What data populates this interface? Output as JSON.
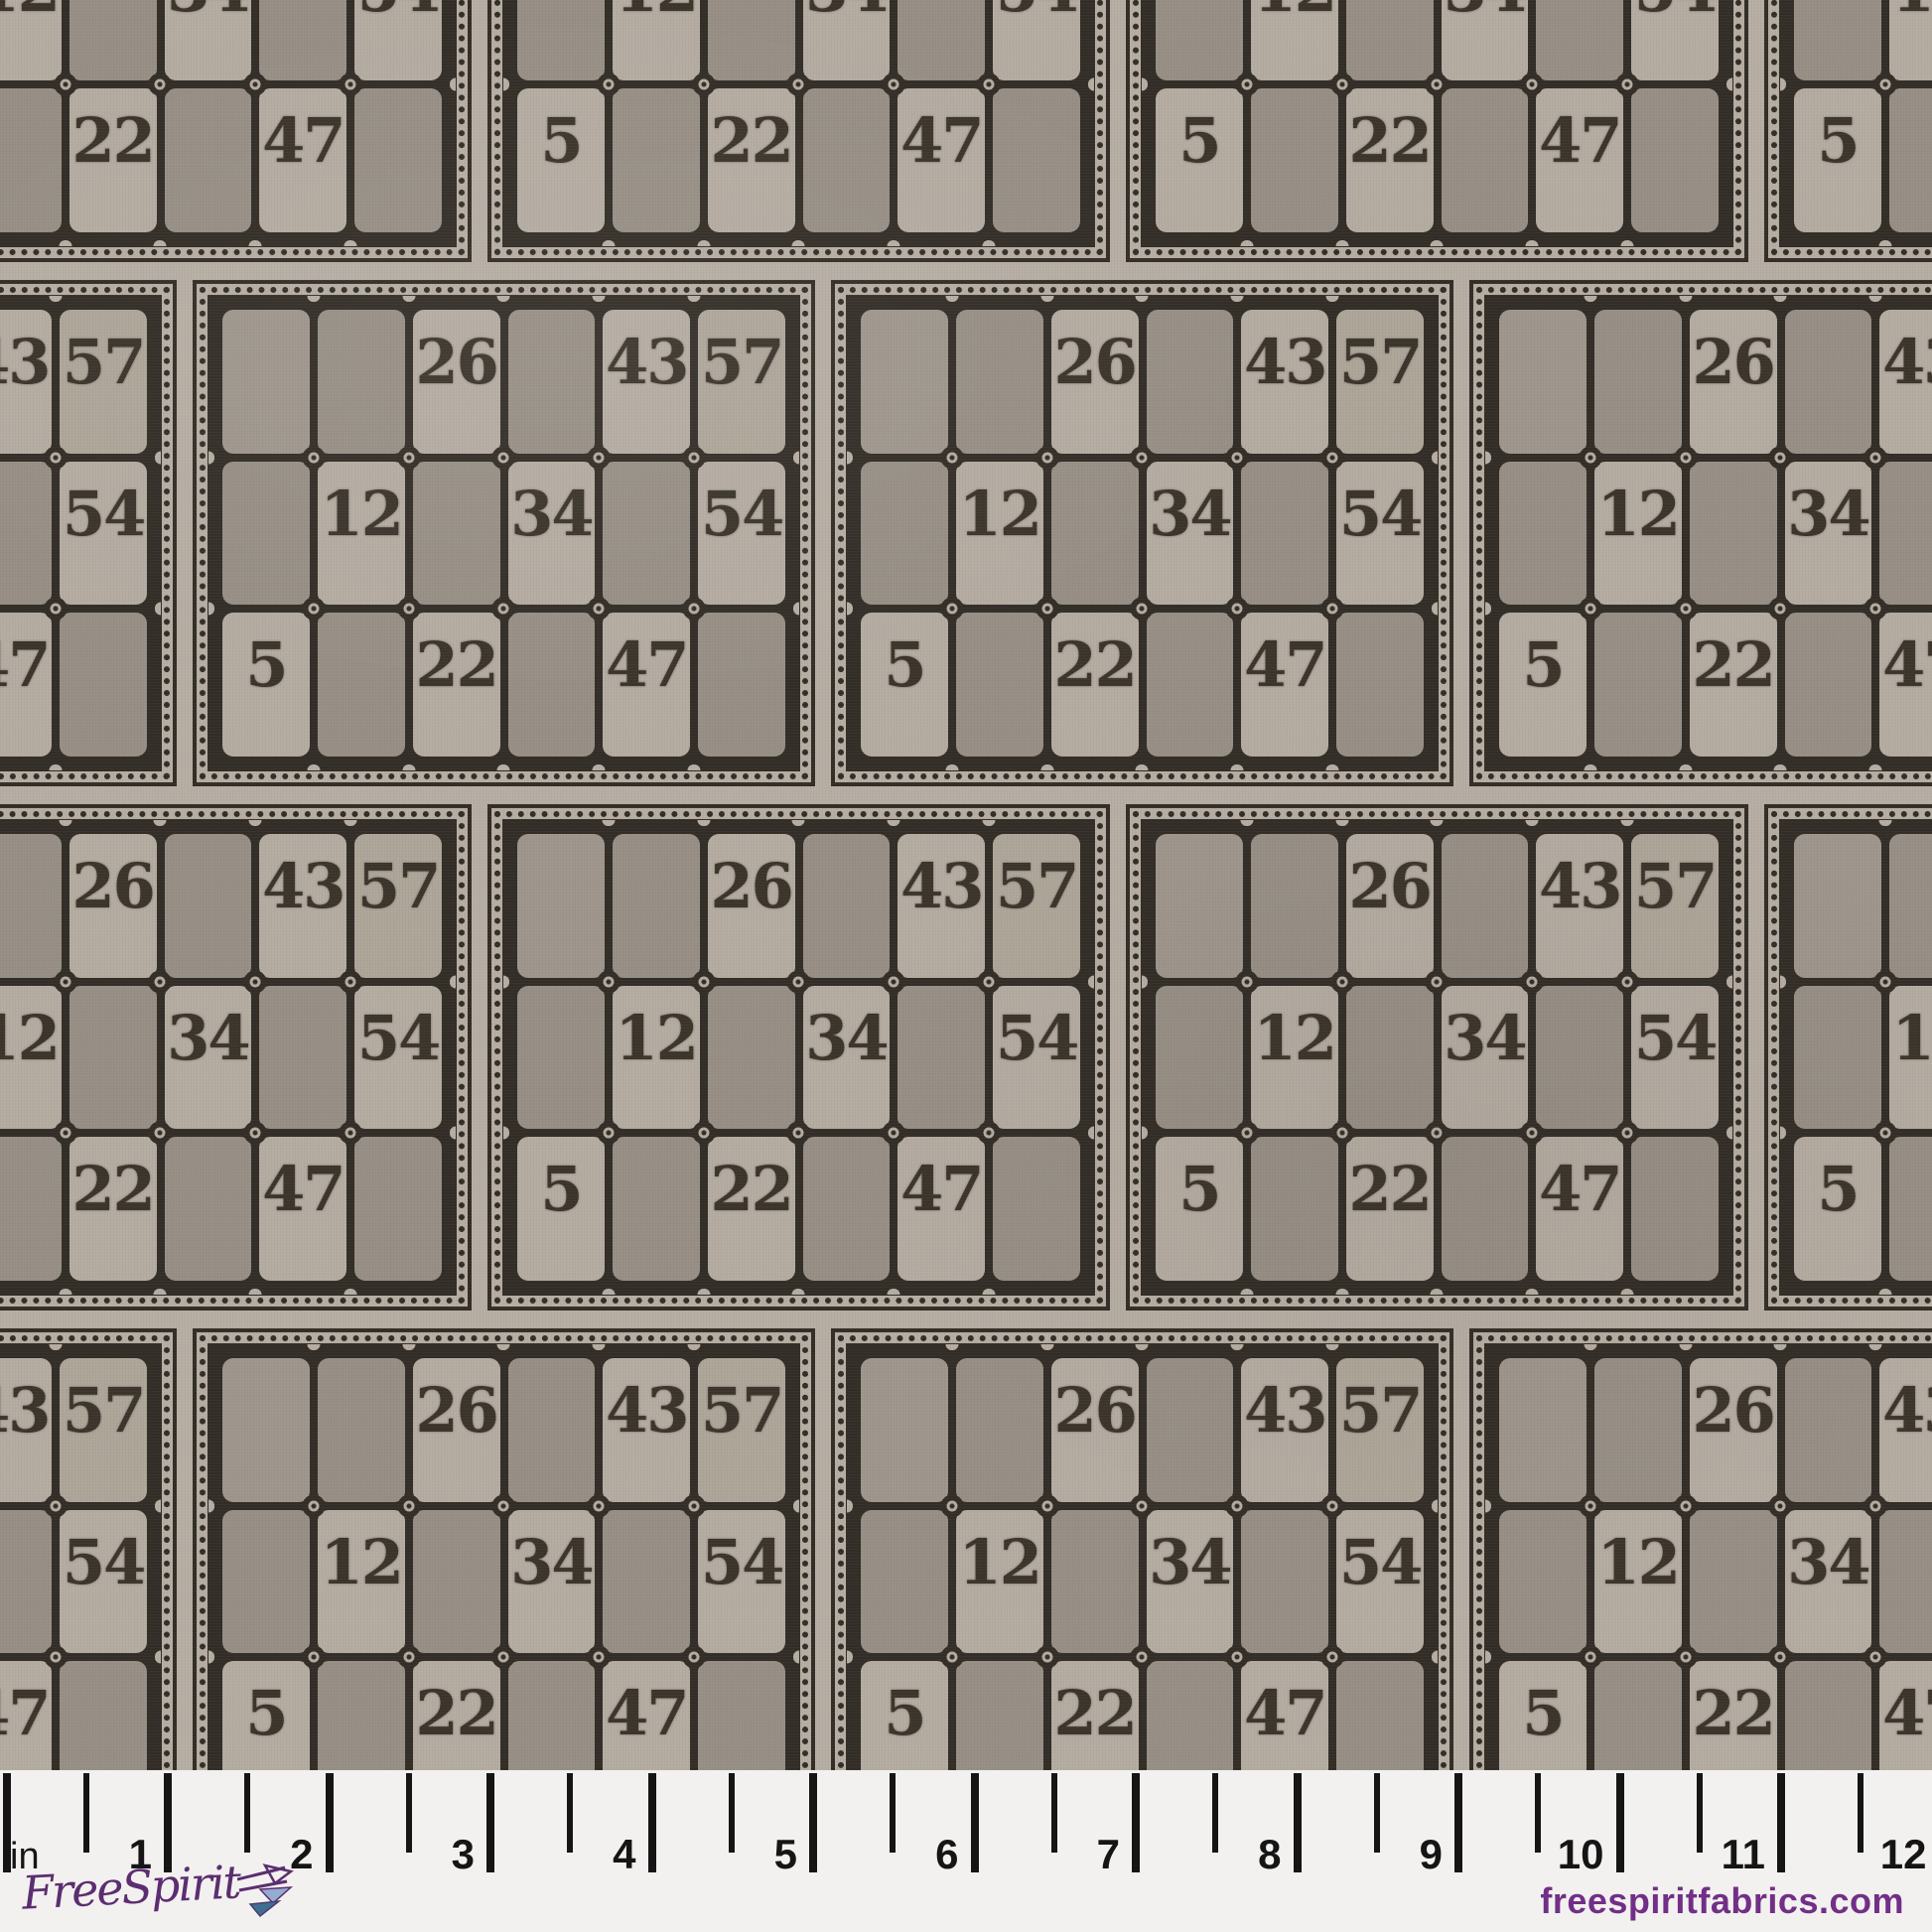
{
  "fabric": {
    "description": "repeating vintage lotto game-card print",
    "card": {
      "rows": [
        [
          "",
          "",
          "26",
          "",
          "43",
          "57"
        ],
        [
          "",
          "12",
          "",
          "34",
          "",
          "54"
        ],
        [
          "5",
          "",
          "22",
          "",
          "47",
          ""
        ]
      ],
      "shading": [
        [
          "dark",
          "dark",
          "light",
          "dark",
          "light",
          "light"
        ],
        [
          "dark",
          "light",
          "dark",
          "light",
          "dark",
          "light"
        ],
        [
          "light",
          "dark",
          "light",
          "dark",
          "light",
          "dark"
        ]
      ]
    },
    "colors": {
      "base": "#b6ada3",
      "cell_light": "#b4aba1",
      "cell_light2": "#aea599",
      "cell_dark": "#9e968c",
      "cell_dark2": "#978f85",
      "ink": "#322d26"
    }
  },
  "ruler": {
    "unit_label": "in",
    "numbers": [
      "1",
      "2",
      "3",
      "4",
      "5",
      "6",
      "7",
      "8",
      "9",
      "10",
      "11",
      "12"
    ],
    "background": "#f2f1ef",
    "ink": "#151515"
  },
  "footer": {
    "brand_script": "FreeSpirit",
    "website": "freespiritfabrics.com",
    "logo_purple": "#5c2d71",
    "site_purple": "#722f87",
    "airplane_blue_light": "#94acd0",
    "airplane_blue_dark": "#3e6f92"
  }
}
